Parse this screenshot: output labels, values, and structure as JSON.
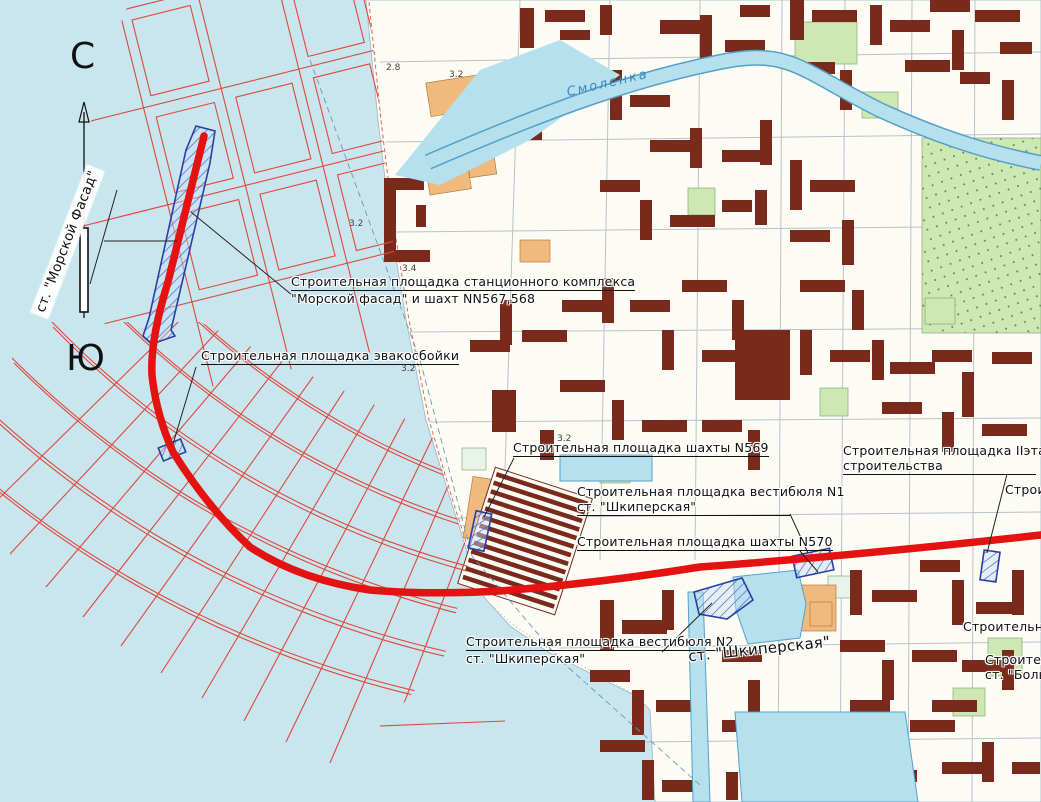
{
  "map": {
    "compass": {
      "north": "С",
      "south": "Ю"
    },
    "river_label": "Смоленка",
    "labels": {
      "station_morskoy": "ст. \"Морской Фасад\"",
      "site_station_1": "Строительная площадка станционного комплекса",
      "site_station_2": "\"Морской фасад\" и шахт NN567,568",
      "site_evac": "Строительная площадка эвакосбойки",
      "site_shaft569": "Строительная площадка шахты N569",
      "site_vest1_1": "Строительная площадка вестибюля N1",
      "site_vest1_2": "ст. \"Шкиперская\"",
      "site_shaft570": "Строительная площадка шахты N570",
      "site_stage2_1": "Строительная площадка IIэтапа",
      "site_stage2_2": "строительства",
      "site_vest2_1": "Строительная площадка вестибюля N2",
      "site_vest2_2": "ст. \"Шкиперская\"",
      "station_shkiperskaya": "ст. \"Шкиперская\"",
      "edge_partial_1": "Строи",
      "edge_partial_2": "Строительная",
      "edge_partial_3": "Строитель",
      "edge_partial_4": "ст. \"Больш"
    },
    "spots": [
      {
        "v": "2.8"
      },
      {
        "v": "3.2"
      },
      {
        "v": "3.2"
      },
      {
        "v": "3.4"
      },
      {
        "v": "3.2"
      },
      {
        "v": "3.2"
      }
    ],
    "colors": {
      "water": "#c9e6ef",
      "land": "#fcfcf5",
      "route_red": "#e51212",
      "plan_grid_red": "#e0473a",
      "building_maroon": "#7a2a1c",
      "building_orange": "#f0b97e",
      "park_green": "#cde8b2",
      "marker_blue": "#2a3fa5",
      "river_blue": "#b5e0ee"
    }
  }
}
